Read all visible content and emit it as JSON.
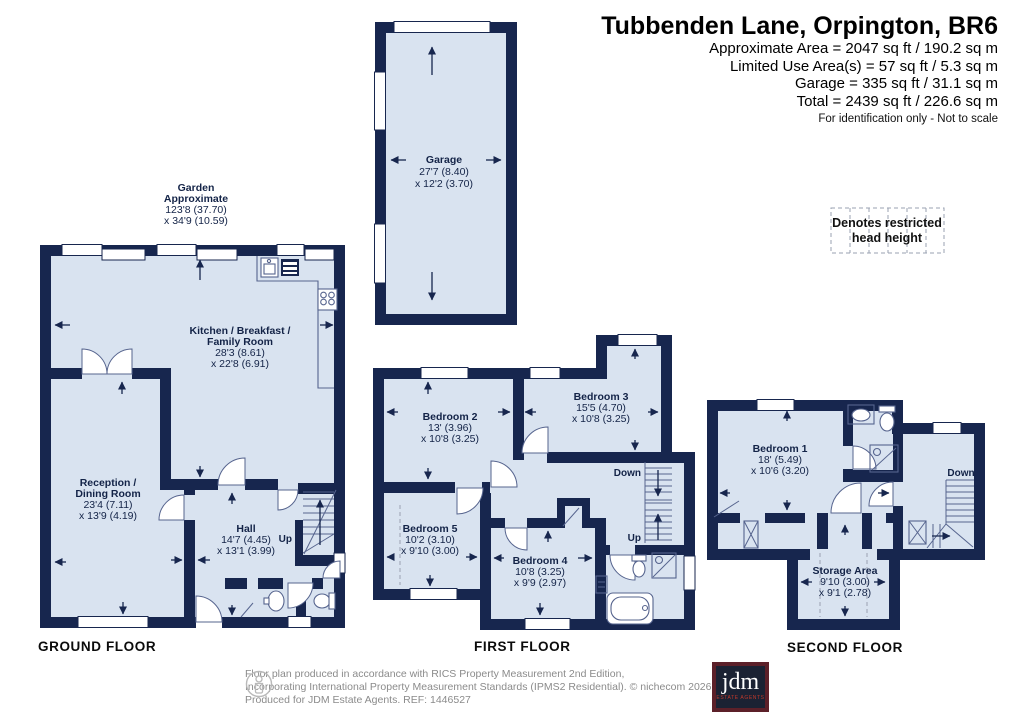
{
  "header": {
    "title": "Tubbenden Lane, Orpington, BR6",
    "area_lines": [
      "Approximate Area = 2047 sq ft / 190.2 sq m",
      "Limited Use Area(s) = 57 sq ft / 5.3 sq m",
      "Garage = 335 sq ft / 31.1 sq m",
      "Total = 2439 sq ft / 226.6 sq m"
    ],
    "note": "For identification only - Not to scale"
  },
  "legend": {
    "line1": "Denotes restricted",
    "line2": "head height"
  },
  "floors": {
    "ground": "GROUND FLOOR",
    "first": "FIRST FLOOR",
    "second": "SECOND FLOOR"
  },
  "rooms": {
    "garden": {
      "name1": "Garden",
      "name2": "Approximate",
      "dim1": "123'8 (37.70)",
      "dim2": "x 34'9 (10.59)"
    },
    "garage": {
      "name1": "Garage",
      "dim1": "27'7 (8.40)",
      "dim2": "x 12'2 (3.70)"
    },
    "kitchen": {
      "name1": "Kitchen / Breakfast /",
      "name2": "Family Room",
      "dim1": "28'3 (8.61)",
      "dim2": "x 22'8 (6.91)"
    },
    "reception": {
      "name1": "Reception /",
      "name2": "Dining Room",
      "dim1": "23'4 (7.11)",
      "dim2": "x 13'9 (4.19)"
    },
    "hall": {
      "name1": "Hall",
      "dim1": "14'7 (4.45)",
      "dim2": "x 13'1 (3.99)"
    },
    "bedroom2": {
      "name1": "Bedroom 2",
      "dim1": "13' (3.96)",
      "dim2": "x 10'8 (3.25)"
    },
    "bedroom3": {
      "name1": "Bedroom 3",
      "dim1": "15'5 (4.70)",
      "dim2": "x 10'8 (3.25)"
    },
    "bedroom4": {
      "name1": "Bedroom 4",
      "dim1": "10'8 (3.25)",
      "dim2": "x 9'9 (2.97)"
    },
    "bedroom5": {
      "name1": "Bedroom 5",
      "dim1": "10'2 (3.10)",
      "dim2": "x 9'10 (3.00)"
    },
    "bedroom1": {
      "name1": "Bedroom 1",
      "dim1": "18' (5.49)",
      "dim2": "x 10'6 (3.20)"
    },
    "storage": {
      "name1": "Storage Area",
      "dim1": "9'10 (3.00)",
      "dim2": "x 9'1 (2.78)"
    }
  },
  "stairs": {
    "ground_up": "Up",
    "first_down": "Down",
    "first_up": "Up",
    "second_down": "Down"
  },
  "footer": {
    "line1": "Floor plan produced in accordance with RICS Property Measurement 2nd Edition,",
    "line2": "Incorporating International Property Measurement Standards (IPMS2 Residential).   © nichecom 2026.",
    "line3": "Produced for JDM Estate Agents.   REF: 1446527",
    "logo_text": "jdm",
    "logo_sub": "ESTATE AGENTS"
  },
  "colors": {
    "wall": "#17264E",
    "floor": "#D9E3F0",
    "detail": "#56648E",
    "legend_dash": "#9AA2B2",
    "logo_bg": "#1B2233",
    "logo_border": "#5C2029",
    "logo_red": "#C0392B"
  }
}
